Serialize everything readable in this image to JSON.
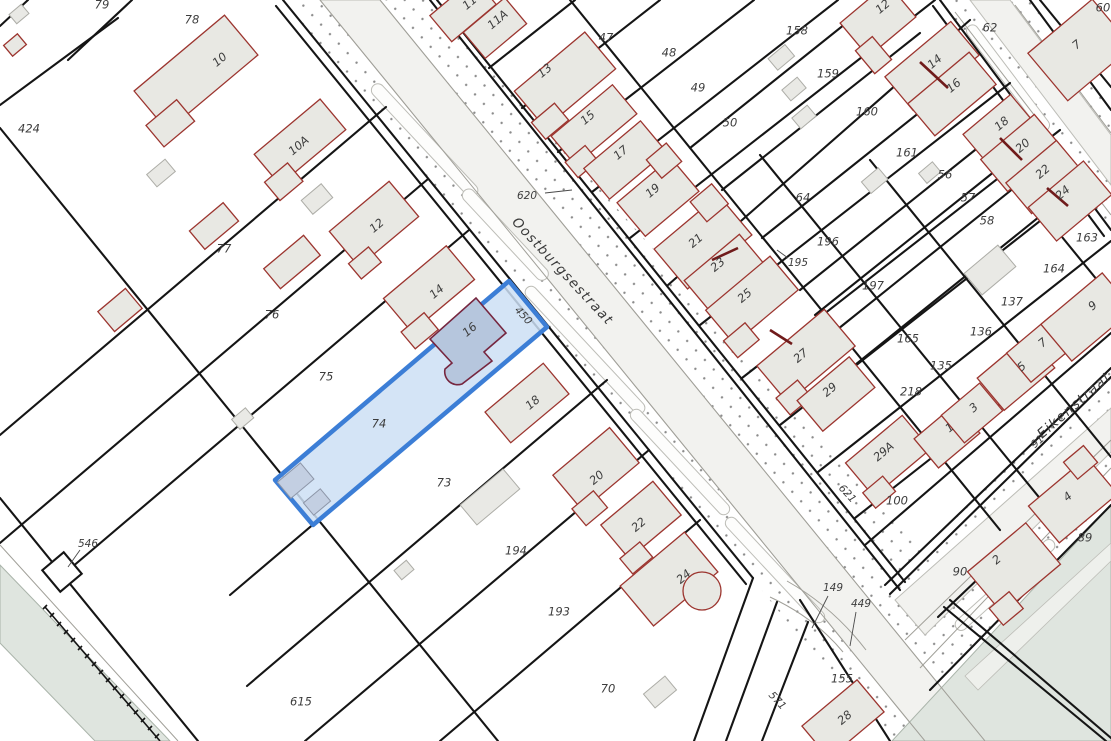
{
  "map": {
    "type": "cadastral-parcel-map",
    "selected": {
      "parcel": "74",
      "building_number": "16"
    },
    "streets": [
      "Oostburgsestraat",
      "Eikenstraat"
    ],
    "colors": {
      "background": "#ffffff",
      "parcel_line": "#151515",
      "building_fill": "#e8e8e3",
      "building_outline": "#9c352f",
      "selected_parcel_fill": "#ccdff5",
      "selected_parcel_border": "#3c7ed6",
      "selected_building_fill": "#b6c6dd",
      "selected_building_outline": "#76263f",
      "street_dot": "#8c8c8c",
      "road_fill": "#f2f2ef",
      "water_fill": "#dfe5df",
      "label": "#3d3d3d"
    },
    "labels": [
      {
        "text": "424",
        "x": 29,
        "y": 129,
        "rot": 0,
        "kind": "p"
      },
      {
        "text": "79",
        "x": 102,
        "y": 5,
        "rot": 0,
        "kind": "p"
      },
      {
        "text": "78",
        "x": 192,
        "y": 20,
        "rot": 0,
        "kind": "p"
      },
      {
        "text": "77",
        "x": 224,
        "y": 249,
        "rot": 0,
        "kind": "p"
      },
      {
        "text": "76",
        "x": 272,
        "y": 315,
        "rot": 0,
        "kind": "p"
      },
      {
        "text": "75",
        "x": 326,
        "y": 377,
        "rot": 0,
        "kind": "p"
      },
      {
        "text": "74",
        "x": 379,
        "y": 424,
        "rot": 0,
        "kind": "p"
      },
      {
        "text": "73",
        "x": 444,
        "y": 483,
        "rot": 0,
        "kind": "p"
      },
      {
        "text": "194",
        "x": 516,
        "y": 551,
        "rot": 0,
        "kind": "p"
      },
      {
        "text": "193",
        "x": 559,
        "y": 612,
        "rot": 0,
        "kind": "p"
      },
      {
        "text": "70",
        "x": 608,
        "y": 689,
        "rot": 0,
        "kind": "p"
      },
      {
        "text": "615",
        "x": 301,
        "y": 702,
        "rot": 0,
        "kind": "p"
      },
      {
        "text": "47",
        "x": 606,
        "y": 38,
        "rot": 0,
        "kind": "p"
      },
      {
        "text": "48",
        "x": 669,
        "y": 53,
        "rot": 0,
        "kind": "p"
      },
      {
        "text": "49",
        "x": 698,
        "y": 88,
        "rot": 0,
        "kind": "p"
      },
      {
        "text": "50",
        "x": 730,
        "y": 123,
        "rot": 0,
        "kind": "p"
      },
      {
        "text": "158",
        "x": 797,
        "y": 31,
        "rot": 0,
        "kind": "p"
      },
      {
        "text": "159",
        "x": 828,
        "y": 74,
        "rot": 0,
        "kind": "p"
      },
      {
        "text": "160",
        "x": 867,
        "y": 112,
        "rot": 0,
        "kind": "p"
      },
      {
        "text": "161",
        "x": 907,
        "y": 153,
        "rot": 0,
        "kind": "p"
      },
      {
        "text": "64",
        "x": 803,
        "y": 198,
        "rot": 0,
        "kind": "p"
      },
      {
        "text": "56",
        "x": 945,
        "y": 175,
        "rot": 0,
        "kind": "p"
      },
      {
        "text": "57",
        "x": 968,
        "y": 198,
        "rot": 0,
        "kind": "p"
      },
      {
        "text": "58",
        "x": 987,
        "y": 221,
        "rot": 0,
        "kind": "p"
      },
      {
        "text": "196",
        "x": 828,
        "y": 242,
        "rot": 0,
        "kind": "p"
      },
      {
        "text": "197",
        "x": 873,
        "y": 286,
        "rot": 0,
        "kind": "p"
      },
      {
        "text": "165",
        "x": 908,
        "y": 339,
        "rot": 0,
        "kind": "p"
      },
      {
        "text": "135",
        "x": 941,
        "y": 366,
        "rot": 0,
        "kind": "p"
      },
      {
        "text": "218",
        "x": 911,
        "y": 392,
        "rot": 0,
        "kind": "p"
      },
      {
        "text": "136",
        "x": 981,
        "y": 332,
        "rot": 0,
        "kind": "p"
      },
      {
        "text": "137",
        "x": 1012,
        "y": 302,
        "rot": 0,
        "kind": "p"
      },
      {
        "text": "163",
        "x": 1087,
        "y": 238,
        "rot": 0,
        "kind": "p"
      },
      {
        "text": "164",
        "x": 1054,
        "y": 269,
        "rot": 0,
        "kind": "p"
      },
      {
        "text": "100",
        "x": 897,
        "y": 501,
        "rot": 0,
        "kind": "p"
      },
      {
        "text": "155",
        "x": 842,
        "y": 679,
        "rot": 0,
        "kind": "p"
      },
      {
        "text": "62",
        "x": 990,
        "y": 28,
        "rot": 0,
        "kind": "p"
      },
      {
        "text": "60",
        "x": 1103,
        "y": 8,
        "rot": 0,
        "kind": "p"
      },
      {
        "text": "89",
        "x": 1085,
        "y": 538,
        "rot": 0,
        "kind": "p"
      },
      {
        "text": "90",
        "x": 960,
        "y": 572,
        "rot": 0,
        "kind": "p"
      },
      {
        "text": "10",
        "x": 220,
        "y": 60,
        "rot": -40,
        "kind": "h"
      },
      {
        "text": "10A",
        "x": 299,
        "y": 146,
        "rot": -40,
        "kind": "h"
      },
      {
        "text": "11",
        "x": 470,
        "y": 3,
        "rot": -40,
        "kind": "h"
      },
      {
        "text": "11A",
        "x": 498,
        "y": 20,
        "rot": -40,
        "kind": "h"
      },
      {
        "text": "12",
        "x": 377,
        "y": 226,
        "rot": -40,
        "kind": "h"
      },
      {
        "text": "13",
        "x": 545,
        "y": 71,
        "rot": -40,
        "kind": "h"
      },
      {
        "text": "14",
        "x": 437,
        "y": 292,
        "rot": -40,
        "kind": "h"
      },
      {
        "text": "15",
        "x": 588,
        "y": 118,
        "rot": -40,
        "kind": "h"
      },
      {
        "text": "16",
        "x": 470,
        "y": 330,
        "rot": -40,
        "kind": "h"
      },
      {
        "text": "17",
        "x": 621,
        "y": 153,
        "rot": -40,
        "kind": "h"
      },
      {
        "text": "18",
        "x": 533,
        "y": 403,
        "rot": -40,
        "kind": "h"
      },
      {
        "text": "19",
        "x": 653,
        "y": 191,
        "rot": -40,
        "kind": "h"
      },
      {
        "text": "20",
        "x": 597,
        "y": 478,
        "rot": -40,
        "kind": "h"
      },
      {
        "text": "21",
        "x": 696,
        "y": 241,
        "rot": -40,
        "kind": "h"
      },
      {
        "text": "22",
        "x": 639,
        "y": 525,
        "rot": -40,
        "kind": "h"
      },
      {
        "text": "23",
        "x": 718,
        "y": 265,
        "rot": -40,
        "kind": "h"
      },
      {
        "text": "24",
        "x": 684,
        "y": 577,
        "rot": -40,
        "kind": "h"
      },
      {
        "text": "25",
        "x": 745,
        "y": 296,
        "rot": -40,
        "kind": "h"
      },
      {
        "text": "27",
        "x": 801,
        "y": 356,
        "rot": -40,
        "kind": "h"
      },
      {
        "text": "28",
        "x": 845,
        "y": 718,
        "rot": -40,
        "kind": "h"
      },
      {
        "text": "29",
        "x": 830,
        "y": 390,
        "rot": -40,
        "kind": "h"
      },
      {
        "text": "29A",
        "x": 884,
        "y": 452,
        "rot": -40,
        "kind": "h"
      },
      {
        "text": "12",
        "x": 883,
        "y": 7,
        "rot": -40,
        "kind": "h"
      },
      {
        "text": "14",
        "x": 935,
        "y": 62,
        "rot": -40,
        "kind": "h"
      },
      {
        "text": "16",
        "x": 954,
        "y": 86,
        "rot": -40,
        "kind": "h"
      },
      {
        "text": "18",
        "x": 1002,
        "y": 124,
        "rot": -40,
        "kind": "h"
      },
      {
        "text": "20",
        "x": 1023,
        "y": 146,
        "rot": -40,
        "kind": "h"
      },
      {
        "text": "22",
        "x": 1043,
        "y": 172,
        "rot": -40,
        "kind": "h"
      },
      {
        "text": "24",
        "x": 1063,
        "y": 193,
        "rot": -40,
        "kind": "h"
      },
      {
        "text": "7",
        "x": 1077,
        "y": 45,
        "rot": -40,
        "kind": "h"
      },
      {
        "text": "1",
        "x": 950,
        "y": 428,
        "rot": -40,
        "kind": "h"
      },
      {
        "text": "3",
        "x": 974,
        "y": 408,
        "rot": -40,
        "kind": "h"
      },
      {
        "text": "5",
        "x": 1022,
        "y": 367,
        "rot": -40,
        "kind": "h"
      },
      {
        "text": "7",
        "x": 1043,
        "y": 343,
        "rot": -40,
        "kind": "h"
      },
      {
        "text": "9",
        "x": 1093,
        "y": 306,
        "rot": -40,
        "kind": "h"
      },
      {
        "text": "2",
        "x": 997,
        "y": 560,
        "rot": -40,
        "kind": "h"
      },
      {
        "text": "4",
        "x": 1068,
        "y": 497,
        "rot": -40,
        "kind": "h"
      },
      {
        "text": "Oostburgsestraat",
        "x": 562,
        "y": 272,
        "rot": 47,
        "kind": "s"
      },
      {
        "text": "Eikenstraat",
        "x": 1075,
        "y": 406,
        "rot": -41,
        "kind": "s"
      },
      {
        "text": "620",
        "x": 527,
        "y": 196,
        "rot": 0,
        "kind": "f"
      },
      {
        "text": "450",
        "x": 523,
        "y": 316,
        "rot": 47,
        "kind": "f"
      },
      {
        "text": "546",
        "x": 88,
        "y": 544,
        "rot": 0,
        "kind": "f"
      },
      {
        "text": "195",
        "x": 798,
        "y": 263,
        "rot": 0,
        "kind": "f"
      },
      {
        "text": "149",
        "x": 833,
        "y": 588,
        "rot": 0,
        "kind": "f"
      },
      {
        "text": "449",
        "x": 861,
        "y": 604,
        "rot": 0,
        "kind": "f"
      },
      {
        "text": "571",
        "x": 777,
        "y": 701,
        "rot": 47,
        "kind": "f"
      },
      {
        "text": "621",
        "x": 847,
        "y": 494,
        "rot": 47,
        "kind": "f"
      },
      {
        "text": "91",
        "x": 1038,
        "y": 442,
        "rot": -41,
        "kind": "f"
      }
    ]
  }
}
